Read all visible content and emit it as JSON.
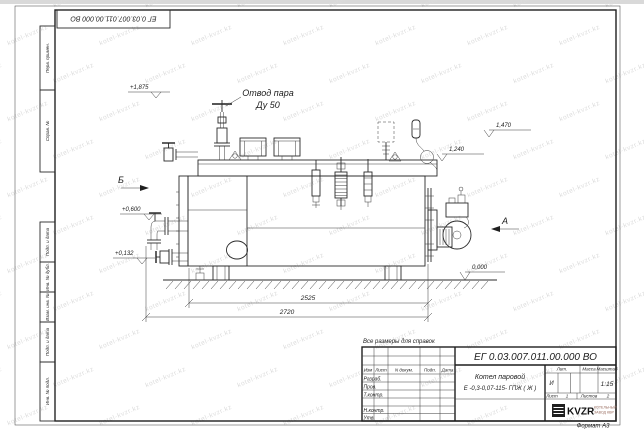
{
  "watermark": {
    "text": "kotel-kvzr.kz"
  },
  "top_stamp": {
    "designation": "ЕГ 0.03.007.011.00.000  ВО"
  },
  "margin_fields": {
    "f1": "Перв. примен.",
    "f2": "Справ. №",
    "f3": "Подп. и дата",
    "f4": "Инв. № дубл.",
    "f5": "Взам. инв. №",
    "f6": "Подп. и дата",
    "f7": "Инв. № подл."
  },
  "drawing": {
    "steam_label_1": "Отвод пара",
    "steam_label_2": "Ду 50",
    "view_a": "А",
    "view_b": "Б",
    "elev_1875": "+1,875",
    "elev_0600": "+0,600",
    "elev_0132": "+0,132",
    "elev_0000": "0,000",
    "elev_1470": "1,470",
    "elev_1240": "1,240",
    "dim_2525": "2525",
    "dim_2720": "2720"
  },
  "note": "Все размеры для справок",
  "title_block": {
    "designation": "ЕГ 0.03.007.011.00.000  ВО",
    "product_name": "Котел паровой",
    "product_type": "Е -0,3-0,07-115- ГПЖ ( Ж )",
    "col_izm": "Изм",
    "col_list": "Лист",
    "col_doc": "N докум.",
    "col_podp": "Подп.",
    "col_data": "Дата",
    "row_razrab": "Разраб.",
    "row_prov": "Пров.",
    "row_tkontr": "Т.контр.",
    "row_nkontr": "Н.контр.",
    "row_utv": "Утв.",
    "lit_label": "Лит.",
    "mass_label": "Масса",
    "scale_label": "Масштаб",
    "lit_value": "И",
    "scale_value": "1:15",
    "sheet_label": "Лист",
    "sheet_value": "1",
    "sheets_label": "Листов",
    "sheets_value": "2",
    "logo_text": "KVZR",
    "logo_sub1": "КОТЕЛЬНЫЙ",
    "logo_sub2": "ЗАВОД КВР",
    "format": "Формат А3"
  }
}
